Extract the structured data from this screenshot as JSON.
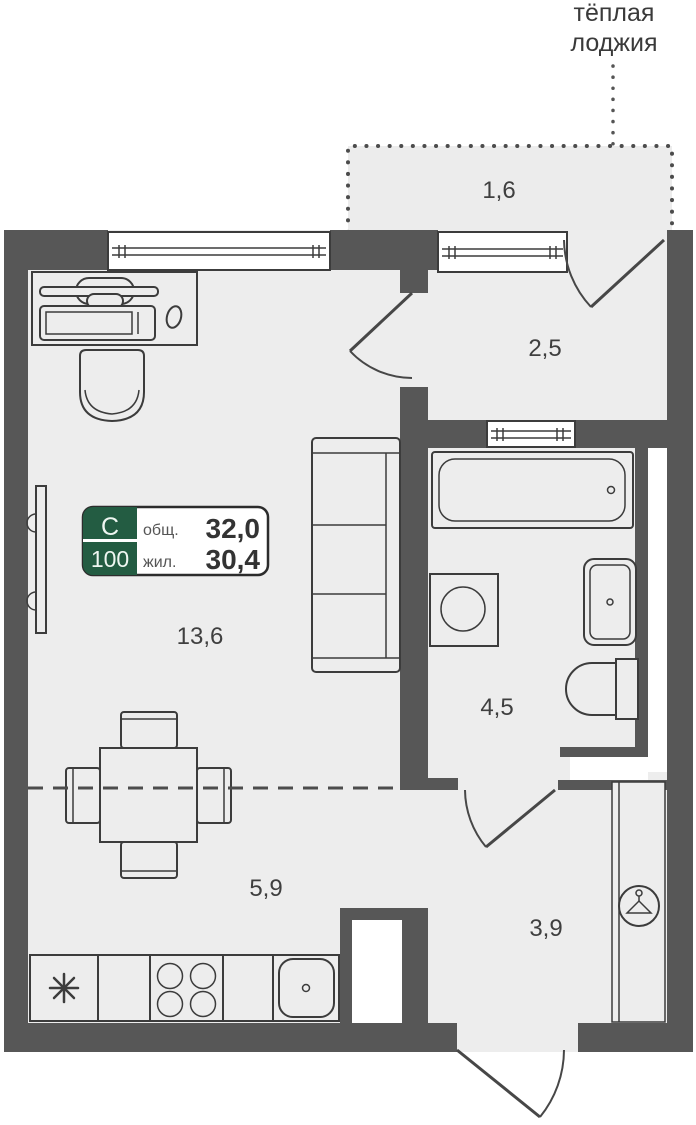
{
  "note": {
    "line1": "тёплая",
    "line2": "лоджия"
  },
  "rooms": {
    "loggia": "1,6",
    "entry_loggia": "2,5",
    "living": "13,6",
    "bathroom": "4,5",
    "kitchen": "5,9",
    "hallway": "3,9"
  },
  "badge": {
    "plan_type": "С",
    "plan_number": "100",
    "total_area_label": "общ.",
    "total_area_value": "32,0",
    "living_area_label": "жил.",
    "living_area_value": "30,4"
  },
  "colors": {
    "wall": "#575757",
    "floor": "#ededed",
    "loggia_floor": "#ececec",
    "badge_green": "#235c42",
    "outline": "#3c3c3c",
    "label_text": "#3f3f3f"
  }
}
